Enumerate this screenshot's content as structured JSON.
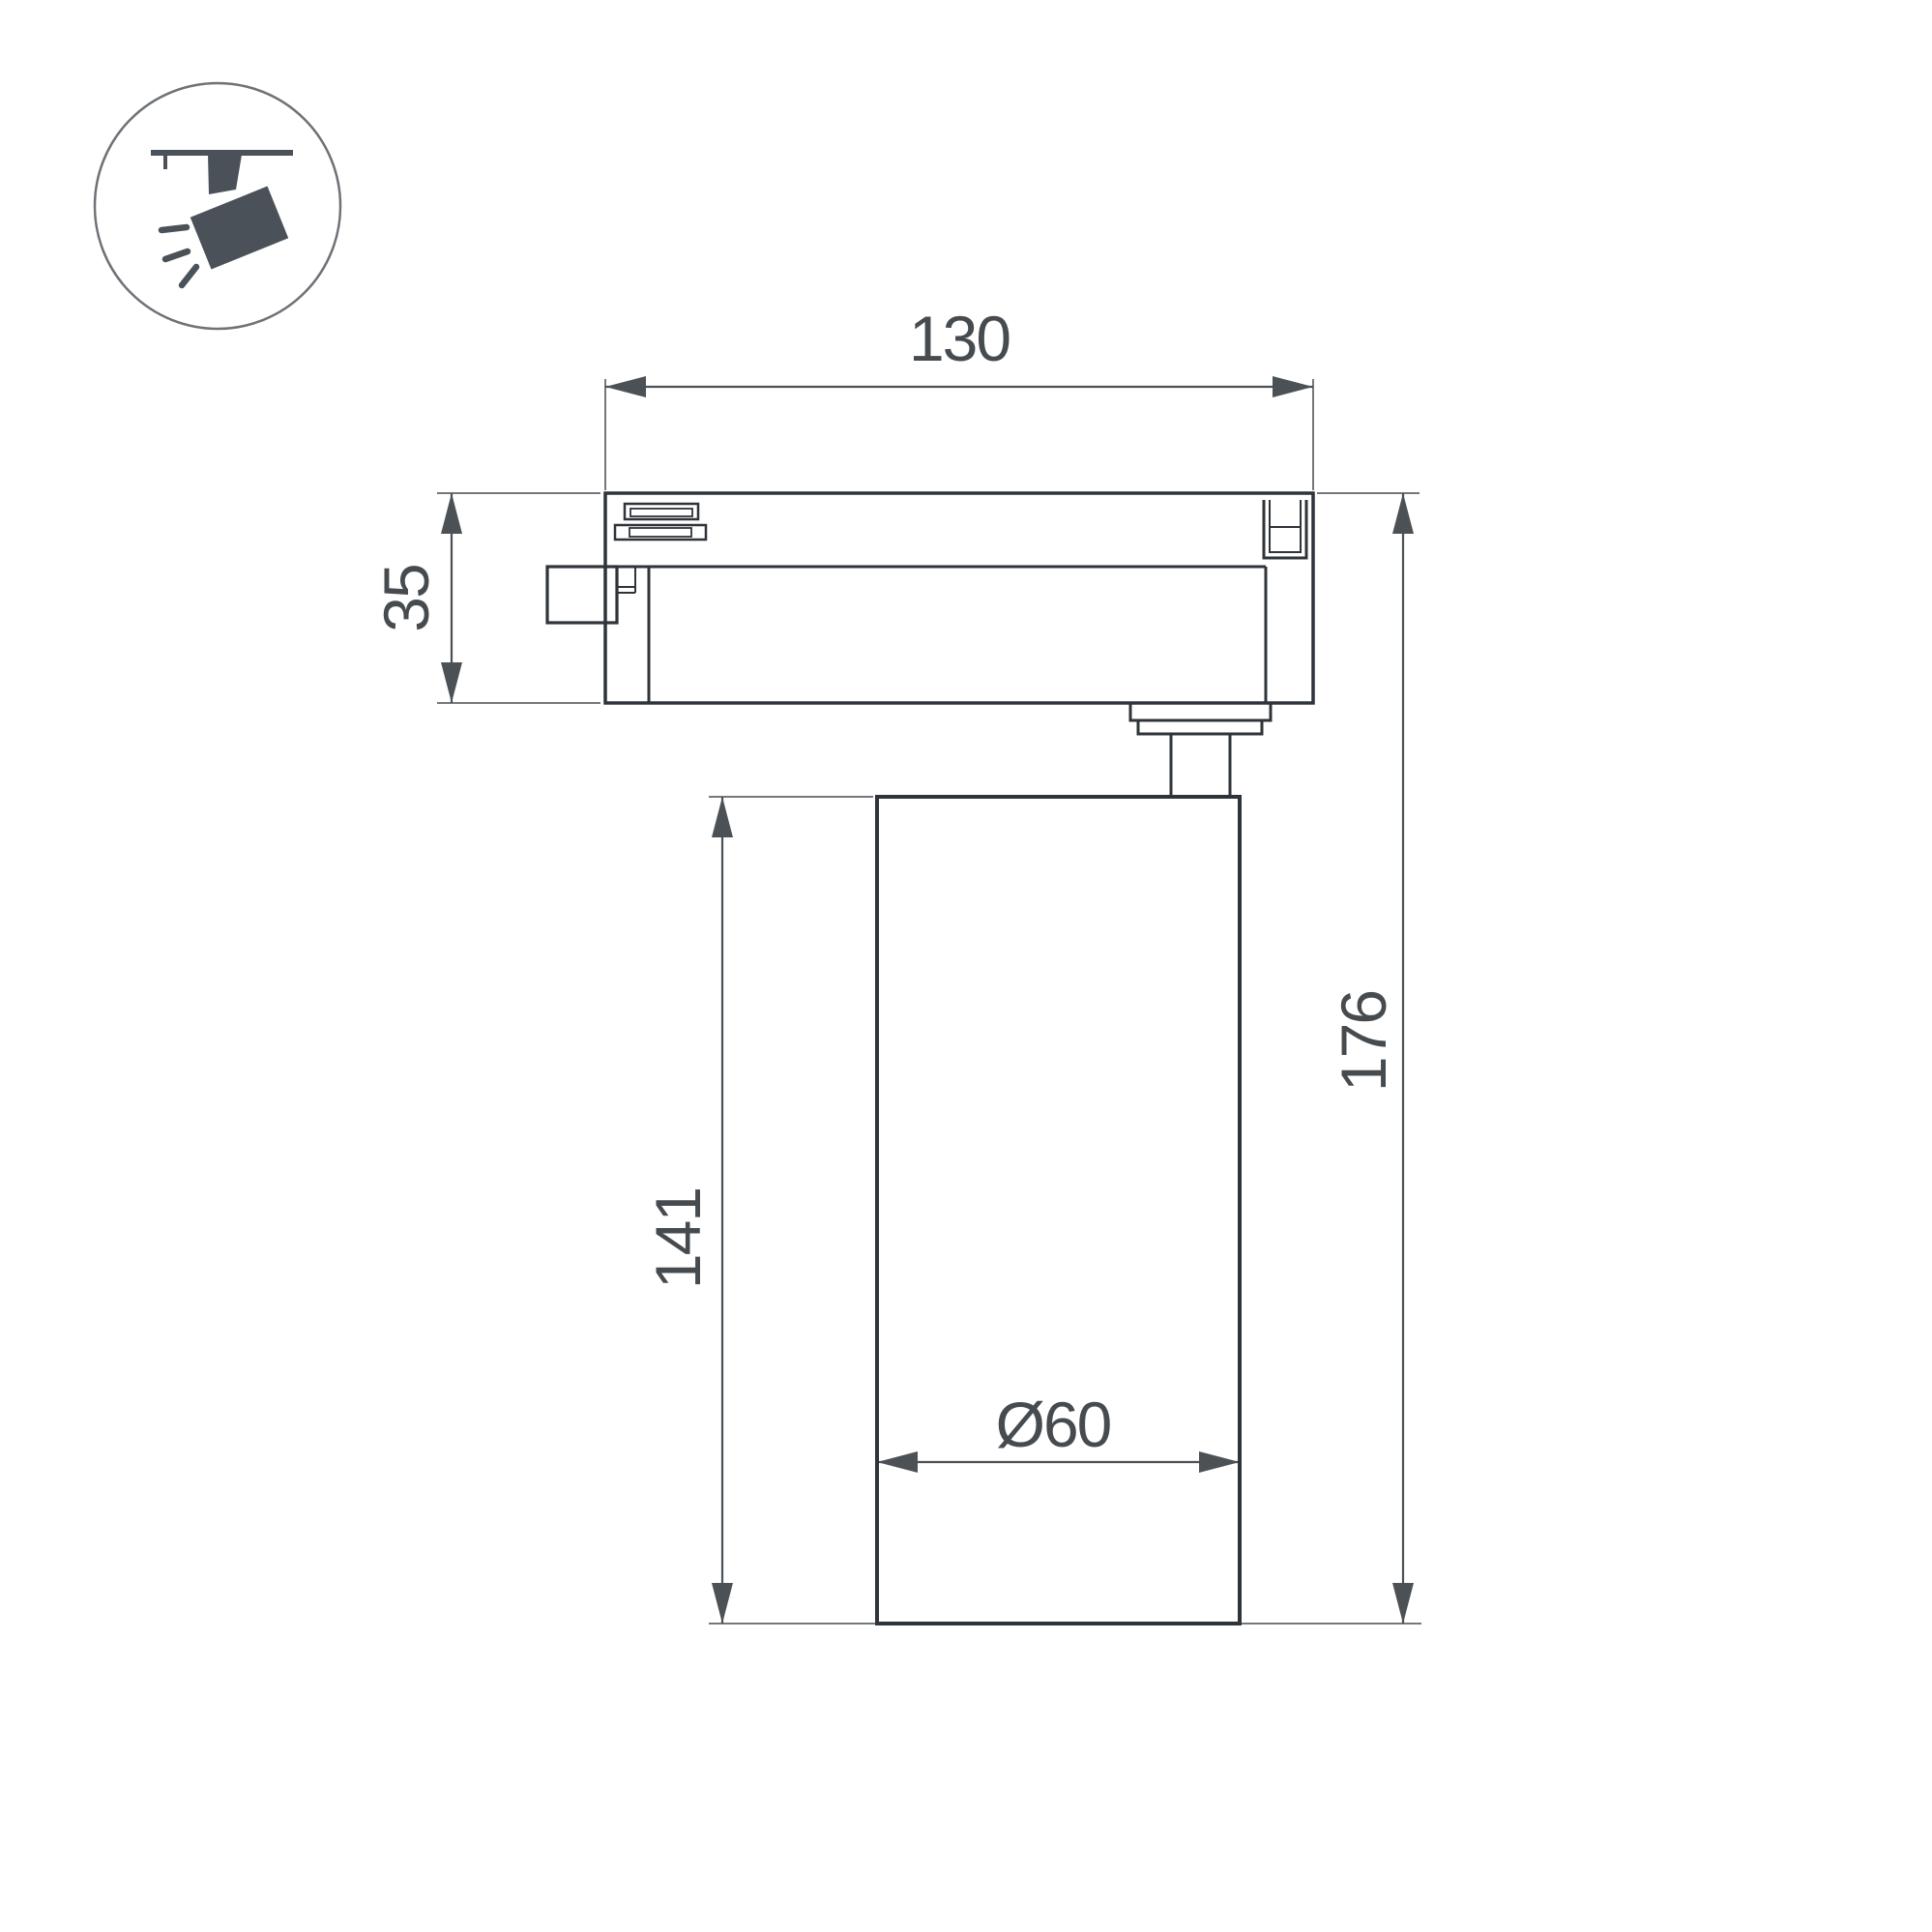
{
  "page": {
    "background_color": "#ffffff",
    "description": "Technical dimension drawing of an LED track spotlight, side view"
  },
  "icon": {
    "name": "track-spotlight-icon",
    "color": "#4a5158",
    "circle_stroke_color": "#6d7277"
  },
  "drawing": {
    "object_line_color": "#2f343a",
    "dimension_line_color": "#4c5156",
    "extension_line_color": "#74787d",
    "text_color": "#464b50",
    "labels": {
      "track_adapter_width_mm": "130",
      "track_adapter_height_mm": "35",
      "lamp_body_height_mm": "141",
      "total_height_mm": "176",
      "lamp_body_diameter_mm": "Ø60"
    }
  }
}
